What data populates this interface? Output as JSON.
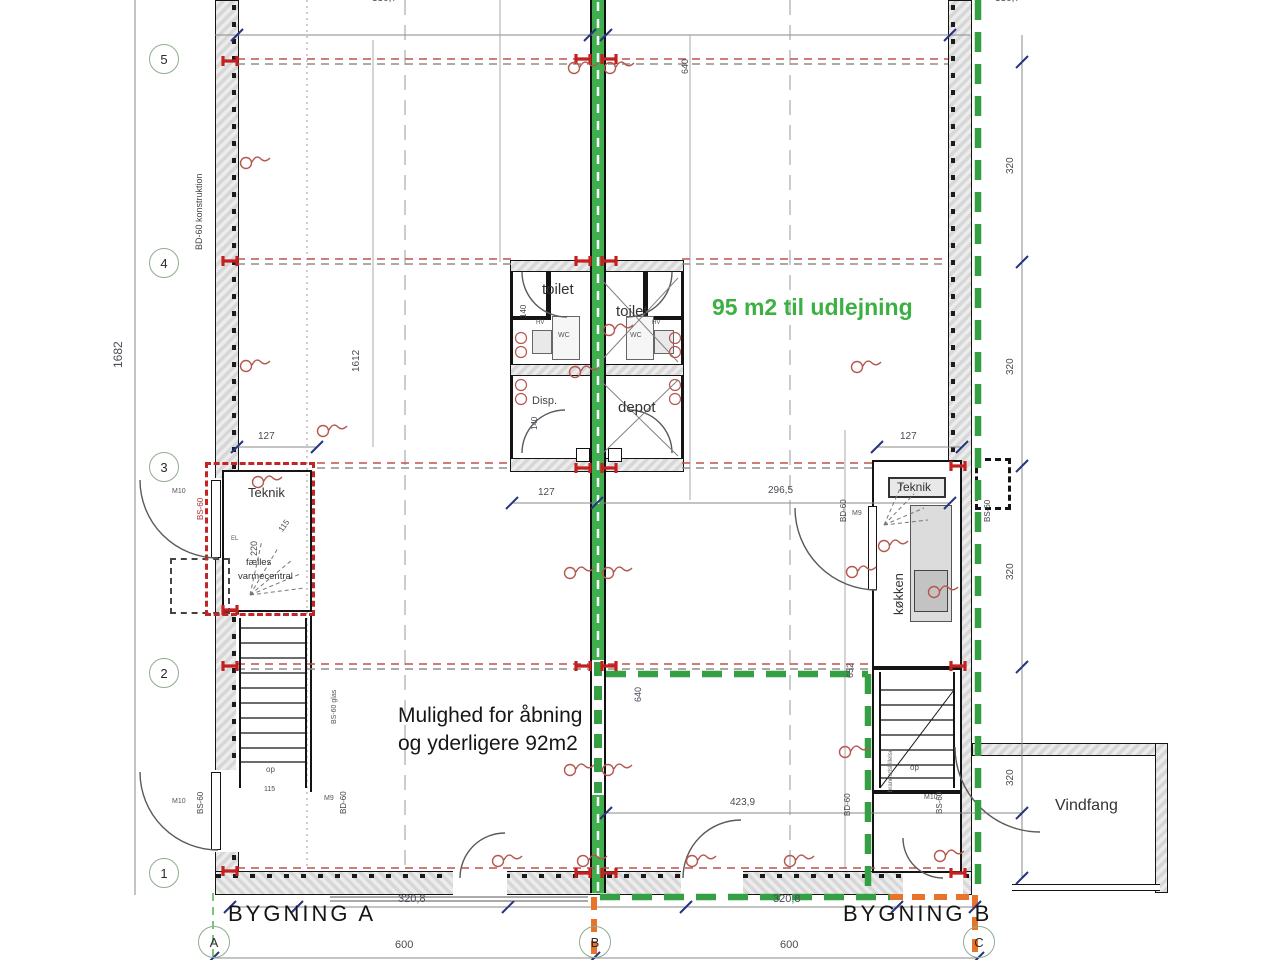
{
  "drawing": {
    "buildings": {
      "a": "BYGNING A",
      "b": "BYGNING B"
    },
    "annotations": {
      "rental": "95 m2 til udlejning",
      "opening_line1": "Mulighed for åbning",
      "opening_line2": "og yderligere 92m2"
    },
    "rooms": {
      "toilet": "toilet",
      "wc": "WC",
      "hv": "HV",
      "disp": "Disp.",
      "depot": "depot",
      "teknik": "Teknik",
      "faelles1": "fælles",
      "faelles2": "varmecentral",
      "koekken": "køkken",
      "vindfang": "Vindfang",
      "op": "op",
      "el": "EL"
    },
    "fire": {
      "bd60_konstruktion": "BD-60 konstruktion",
      "bs60": "BS-60",
      "bd60": "BD-60",
      "bs60_glas": "BS-60 glas",
      "m9": "M9",
      "m10": "M10",
      "brand": "brandadskillelse"
    },
    "grid": {
      "r5": "5",
      "r4": "4",
      "r3": "3",
      "r2": "2",
      "r1": "1",
      "ca": "A",
      "cb": "B",
      "cc": "C"
    },
    "dims": {
      "top": "330,7",
      "total_h": "1682",
      "inner_h": "1612",
      "d640": "640",
      "d652": "652",
      "d127": "127",
      "d296": "296,5",
      "d320": "320",
      "d220": "220",
      "d140": "140",
      "d115": "115",
      "d423": "423,9",
      "d3208": "320,8",
      "d600": "600"
    },
    "colors": {
      "lease_green": "#3cb043",
      "boundary_orange": "#e8742c",
      "grid_red": "#c0504d",
      "wall_dark": "#1a1a1a"
    }
  }
}
